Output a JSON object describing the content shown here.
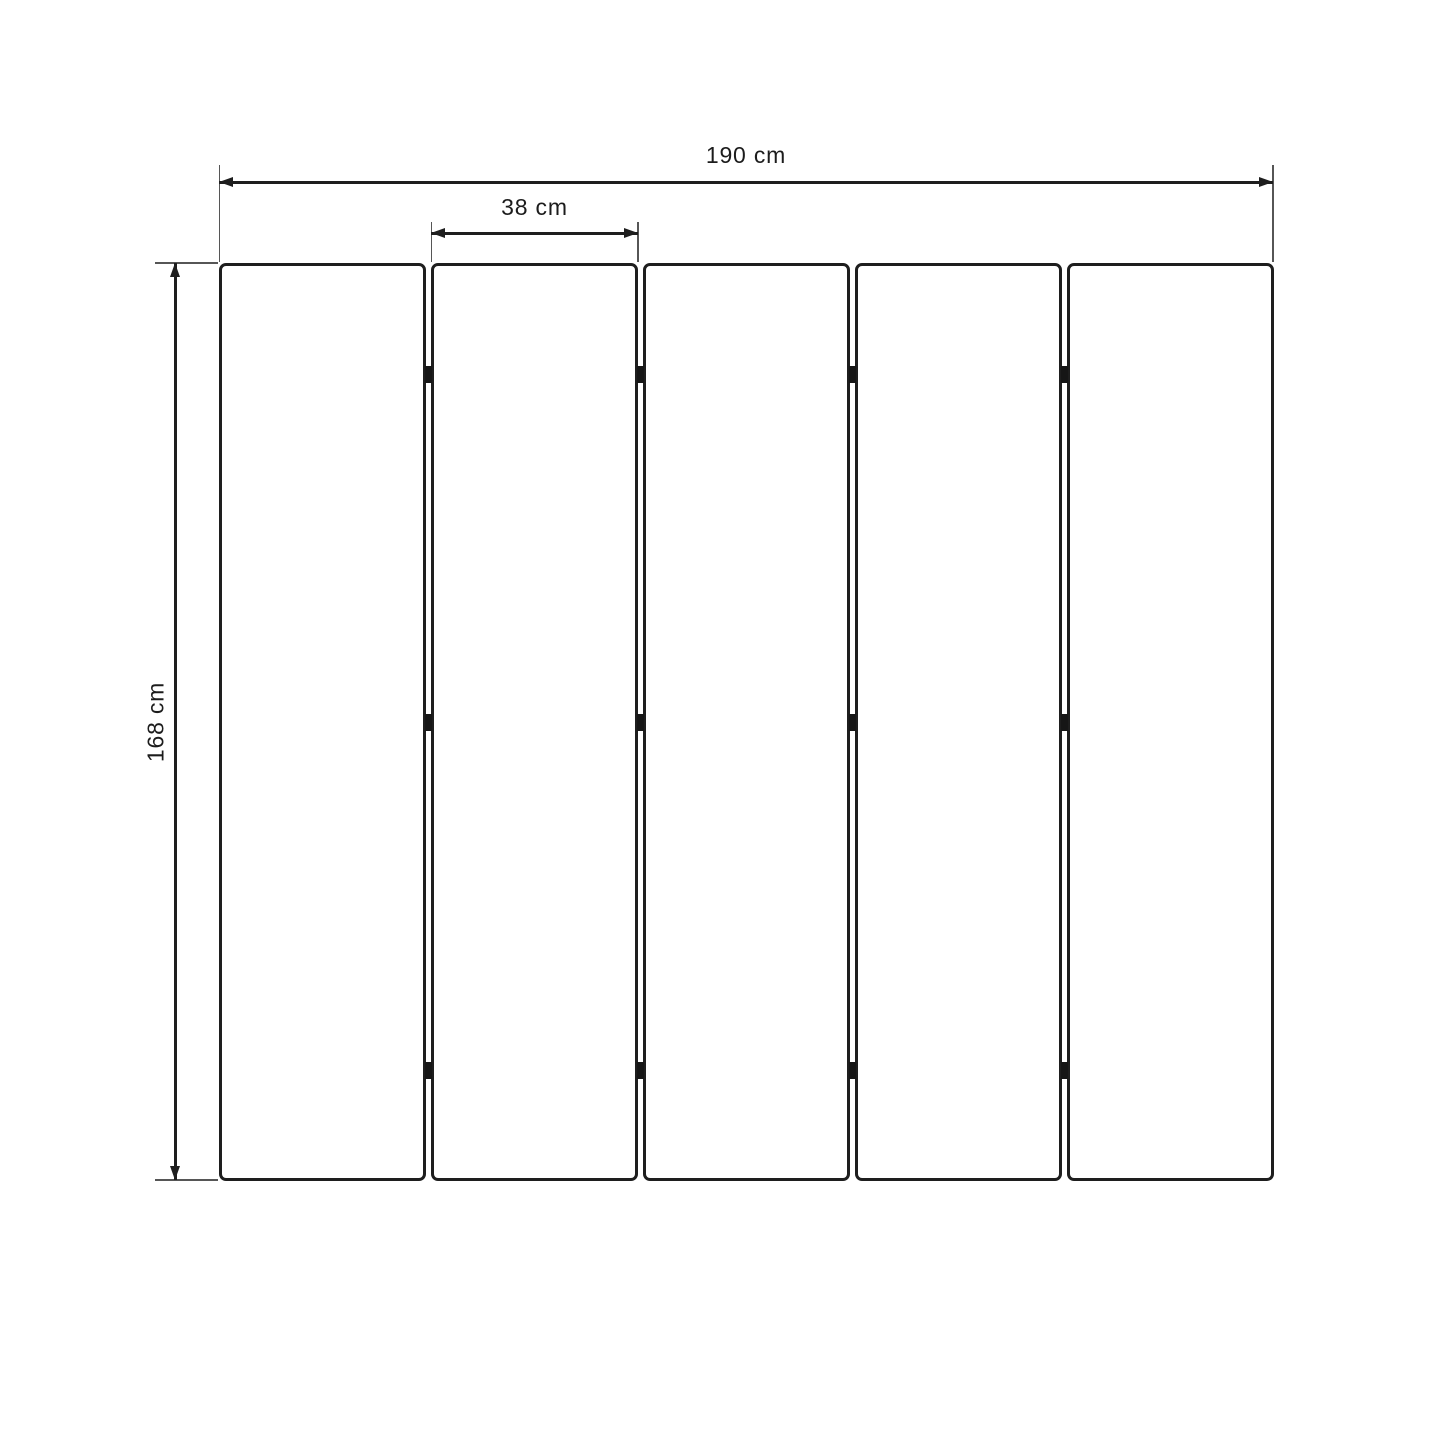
{
  "diagram": {
    "type": "technical-dimension-drawing",
    "background_color": "#ffffff",
    "line_color": "#1e1e1e",
    "extension_line_color": "#565656",
    "dimensions": {
      "total_width": "190 cm",
      "panel_width": "38 cm",
      "height": "168 cm"
    },
    "panel_count": 5,
    "junction_count": 4,
    "hinges_per_junction": 3
  }
}
